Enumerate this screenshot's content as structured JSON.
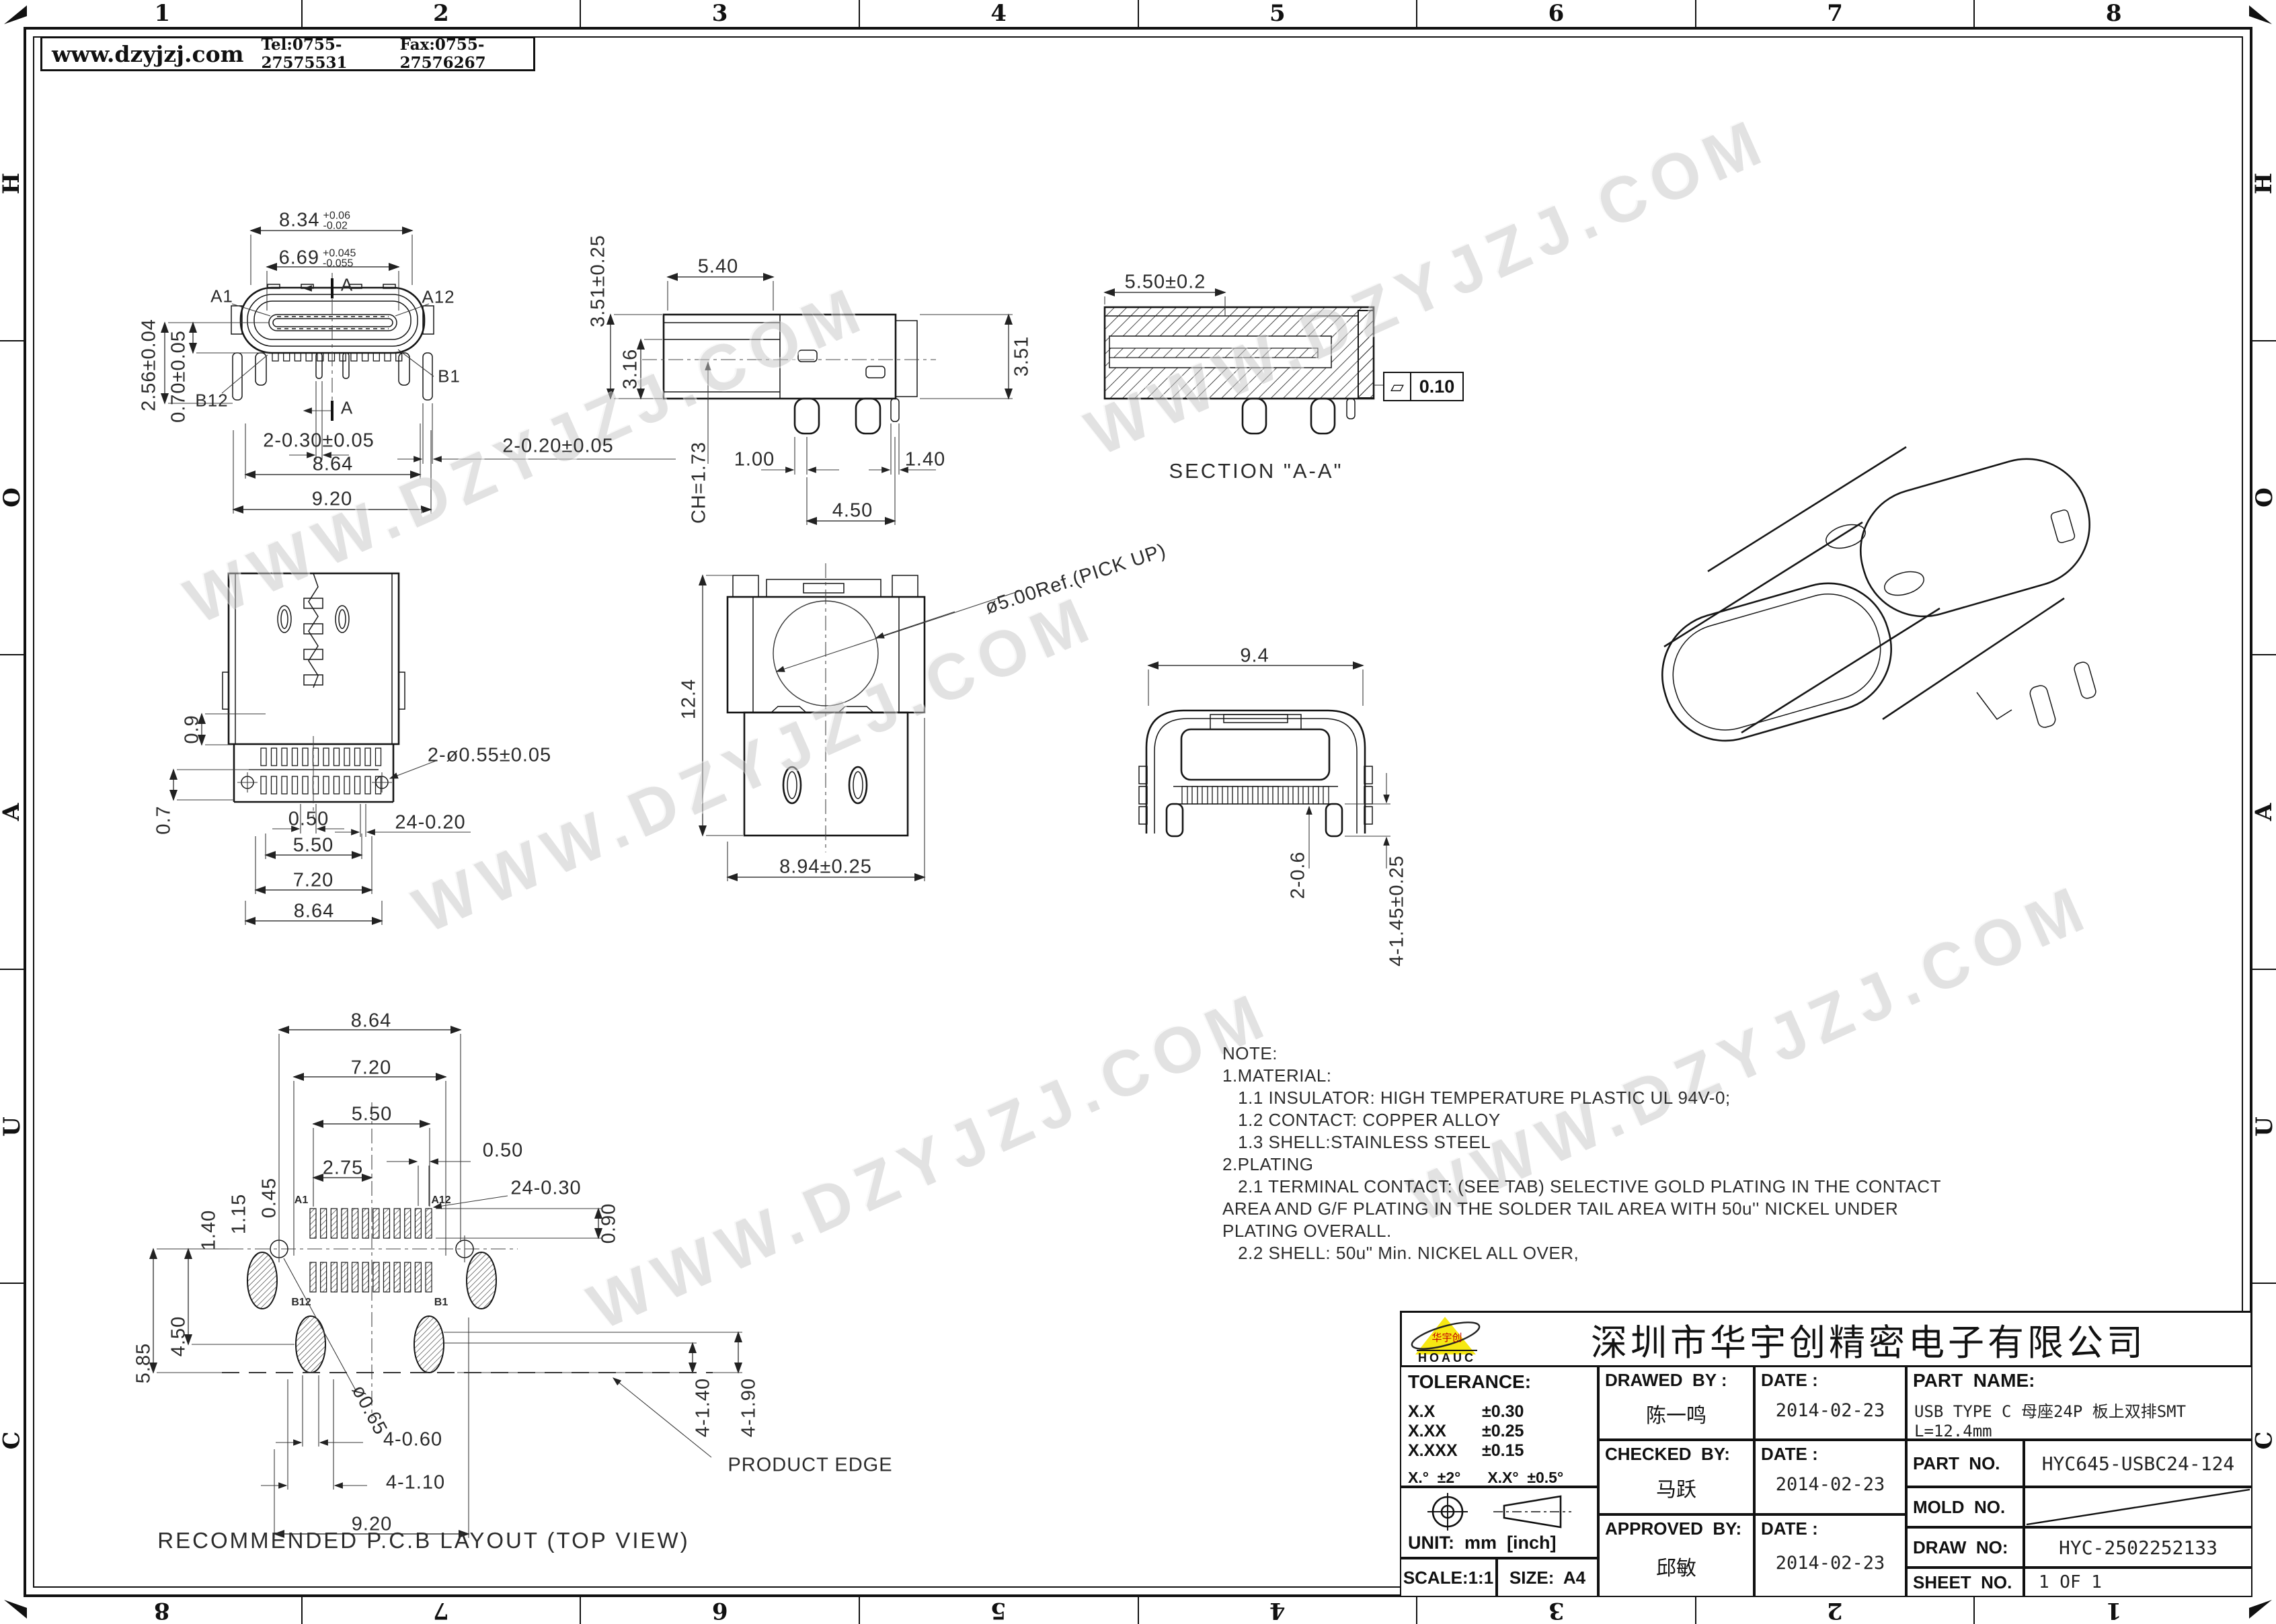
{
  "header": {
    "website": "www.dzyjzj.com",
    "tel": "Tel:0755-27575531",
    "fax": "Fax:0755-27576267"
  },
  "frame": {
    "cols": [
      "1",
      "2",
      "3",
      "4",
      "5",
      "6",
      "7",
      "8"
    ],
    "rows": [
      "H",
      "O",
      "A",
      "U",
      "C"
    ]
  },
  "watermark": {
    "text": "WWW.DZYJZJ.COM"
  },
  "views": {
    "front": {
      "section_mark": "A",
      "a1": "A1",
      "a12": "A12",
      "b1": "B1",
      "b12": "B12",
      "dim_w_shell": "8.34",
      "dim_w_shell_up": "+0.06",
      "dim_w_shell_dn": "-0.02",
      "dim_w_tongue": "6.69",
      "dim_w_tongue_up": "+0.045",
      "dim_w_tongue_dn": "-0.055",
      "dim_h_center": "2.56±0.04",
      "dim_h_tongue": "0.70±0.05",
      "dim_tail_mid": "2-0.30±0.05",
      "dim_tail_side": "2-0.20±0.05",
      "dim_w_legs": "8.64",
      "dim_w_total": "9.20"
    },
    "side": {
      "dim_h_total": "3.51±0.25",
      "dim_top": "5.40",
      "dim_h_body": "3.16",
      "dim_ch": "CH=1.73",
      "dim_pin1": "1.00",
      "dim_pin2": "1.40",
      "dim_span": "4.50",
      "dim_h_right": "3.51"
    },
    "section": {
      "dim_depth": "5.50±0.2",
      "caption": "SECTION \"A-A\"",
      "flatness": "0.10"
    },
    "plan": {
      "dim_edge": "0.9",
      "dim_row": "0.7",
      "dim_holes": "2-ø0.55±0.05",
      "dim_pitch": "0.50",
      "dim_pins": "24-0.20",
      "dim_550": "5.50",
      "dim_720": "7.20",
      "dim_864": "8.64"
    },
    "pickup": {
      "dim_pick": "ø5.00Ref.(PICK UP)",
      "dim_height": "12.4",
      "dim_width": "8.94±0.25"
    },
    "rear": {
      "dim_width": "9.4",
      "dim_tooth": "2-0.6",
      "dim_tail": "4-1.45±0.25"
    },
    "pcb": {
      "dim_864": "8.64",
      "dim_720": "7.20",
      "dim_550": "5.50",
      "dim_275": "2.75",
      "dim_pitch": "0.50",
      "dim_pads": "24-0.30",
      "dim_padlen": "0.90",
      "dim_045": "0.45",
      "dim_115": "1.15",
      "dim_140": "1.40",
      "dim_450": "4.50",
      "dim_585": "5.85",
      "dim_hole": "ø0.65",
      "dim_4060": "4-0.60",
      "dim_4110": "4-1.10",
      "dim_920": "9.20",
      "dim_4140": "4-1.40",
      "dim_4190": "4-1.90",
      "product_edge": "PRODUCT EDGE",
      "a1": "A1",
      "a12": "A12",
      "b1": "B1",
      "b12": "B12",
      "caption": "RECOMMENDED P.C.B LAYOUT (TOP VIEW)"
    }
  },
  "notes": {
    "lines": [
      "NOTE:",
      "1.MATERIAL:",
      "   1.1 INSULATOR: HIGH TEMPERATURE PLASTIC UL 94V-0;",
      "   1.2 CONTACT: COPPER ALLOY",
      "   1.3 SHELL:STAINLESS STEEL",
      "2.PLATING",
      "   2.1 TERMINAL CONTACT: (SEE TAB) SELECTIVE GOLD PLATING IN THE CONTACT",
      "AREA AND G/F PLATING IN THE SOLDER TAIL AREA WITH 50u'' NICKEL UNDER",
      "PLATING OVERALL.",
      "   2.2 SHELL: 50u\" Min. NICKEL ALL OVER,"
    ]
  },
  "title_block": {
    "company": "深圳市华宇创精密电子有限公司",
    "logo_en": "HOAUC",
    "logo_cn": "华宇创",
    "tolerance_label": "TOLERANCE:",
    "tol1": "X.X",
    "tol1v": "±0.30",
    "tol2": "X.XX",
    "tol2v": "±0.25",
    "tol3": "X.XXX",
    "tol3v": "±0.15",
    "tol_deg1": "X.°  ±2°",
    "tol_deg2": "X.X°  ±0.5°",
    "unit_label": "UNIT:  mm  [inch]",
    "scale": "SCALE:1:1",
    "size_label": "SIZE:  A4",
    "drawed_label": "DRAWED  BY :",
    "date_label": "DATE :",
    "checked_label": "CHECKED  BY:",
    "approved_label": "APPROVED  BY:",
    "drawed_by": "陈一鸣",
    "drawed_date": "2014-02-23",
    "checked_by": "马跃",
    "checked_date": "2014-02-23",
    "approved_by": "邱敏",
    "approved_date": "2014-02-23",
    "part_name_label": "PART  NAME:",
    "part_name": "USB TYPE C 母座24P 板上双排SMT L=12.4mm",
    "part_no_label": "PART  NO.",
    "part_no": "HYC645-USBC24-124",
    "mold_no_label": "MOLD  NO.",
    "draw_no_label": "DRAW  NO:",
    "draw_no": "HYC-2502252133",
    "sheet_no_label": "SHEET  NO.",
    "sheet_no": "1 OF 1"
  }
}
